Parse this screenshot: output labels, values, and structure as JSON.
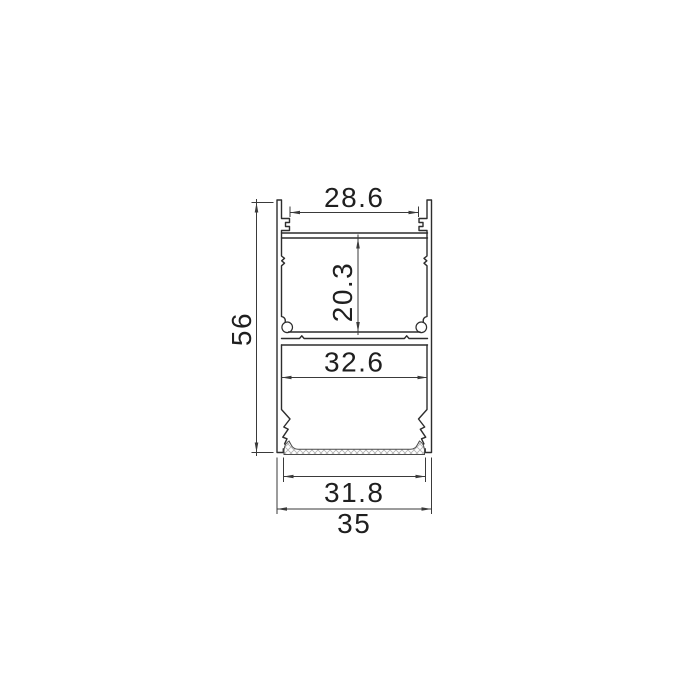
{
  "drawing": {
    "kind": "technical cross-section drawing",
    "subject": "aluminium LED strip profile cross-section with diffuser",
    "background_color": "#ffffff",
    "outline_color": "#2d2d2d",
    "dimension_color": "#3a3a3a",
    "hatch_color": "#b2b2b2"
  },
  "dimensions": {
    "top_opening": {
      "value": "28.6",
      "orientation": "horizontal",
      "location": "top channel opening width"
    },
    "upper_cavity_height": {
      "value": "20.3",
      "orientation": "vertical",
      "location": "middle chamber height"
    },
    "overall_height": {
      "value": "56",
      "orientation": "vertical",
      "location": "left side overall height"
    },
    "lower_cavity_width": {
      "value": "32.6",
      "orientation": "horizontal",
      "location": "bottom chamber inner width"
    },
    "diffuser_width": {
      "value": "31.8",
      "orientation": "horizontal",
      "location": "diffuser strip width"
    },
    "overall_width": {
      "value": "35",
      "orientation": "horizontal",
      "location": "overall outer width"
    }
  }
}
